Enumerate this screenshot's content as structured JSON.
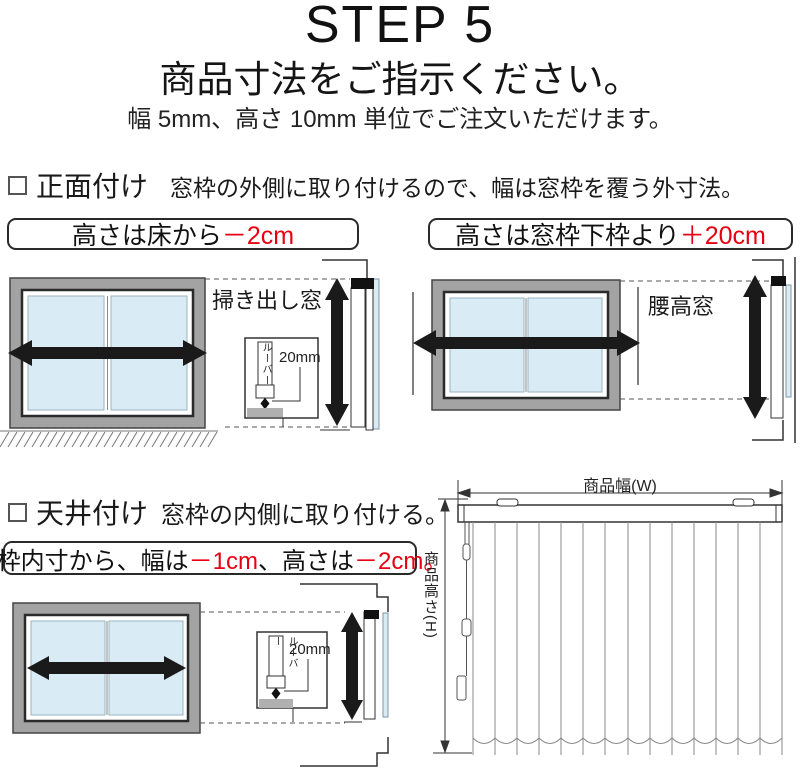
{
  "header": {
    "step": "STEP 5",
    "title": "商品寸法をご指示ください。",
    "subtitle": "幅 5mm、高さ 10mm 単位でご注文いただけます。"
  },
  "front_mount": {
    "title": "正面付け",
    "description": "窓枠の外側に取り付けるので、幅は窓枠を覆う外寸法。",
    "floor_note": {
      "text": "高さは床から",
      "value": "－2cm"
    },
    "sill_note": {
      "text": "高さは窓枠下枠より",
      "value": "＋20cm"
    },
    "floor_window_label": "掃き出し窓",
    "waist_window_label": "腰高窓",
    "louver_label": "ルーバー",
    "gap_label": "20mm"
  },
  "ceiling_mount": {
    "title": "天井付け",
    "description": "窓枠の内側に取り付ける。",
    "note": {
      "p1": "窓枠内寸から、幅は",
      "v1": "－1cm",
      "p2": "、高さは",
      "v2": "－2cm。"
    },
    "louver_label": "ルーバー",
    "gap_label": "20mm"
  },
  "product": {
    "width_label": "商品幅(W)",
    "height_label": "商品高さ(H)"
  },
  "colors": {
    "accent_red": "#e60012",
    "frame_gray": "#a3a3a3",
    "glass_blue": "#d9ecf6",
    "arrow_black": "#1a1a1a"
  }
}
